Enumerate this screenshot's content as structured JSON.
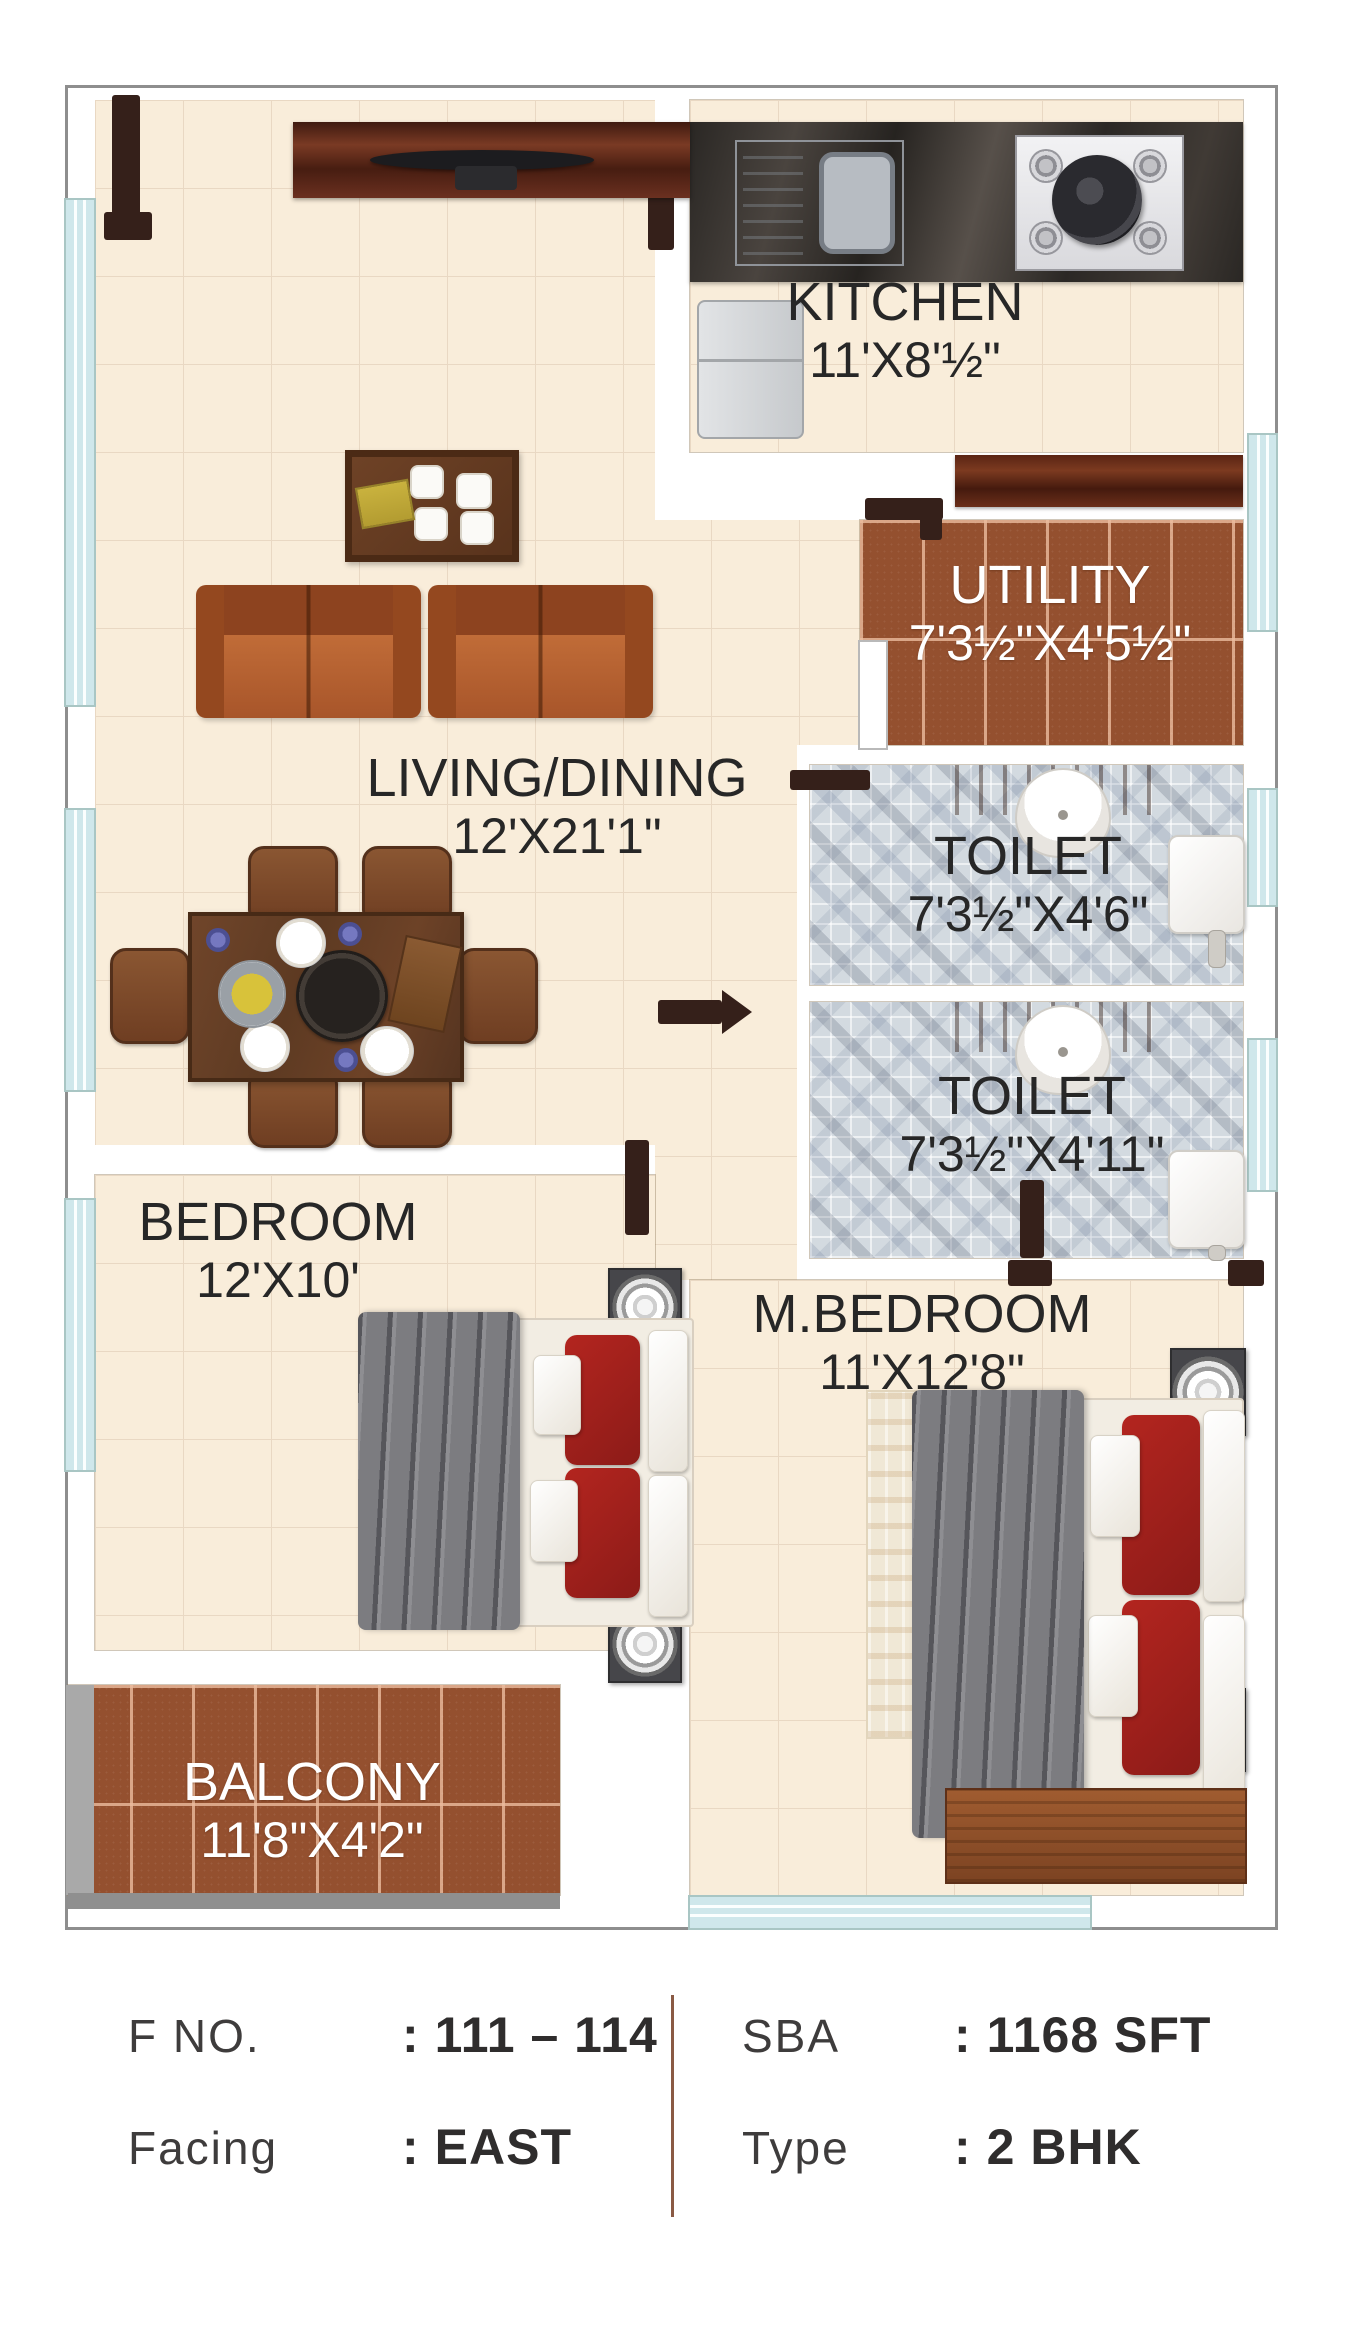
{
  "plan": {
    "rooms": [
      {
        "id": "kitchen",
        "name": "KITCHEN",
        "dims": "11'X8'½\""
      },
      {
        "id": "utility",
        "name": "UTILITY",
        "dims": "7'3½\"X4'5½\""
      },
      {
        "id": "toilet_top",
        "name": "TOILET",
        "dims": "7'3½\"X4'6\""
      },
      {
        "id": "toilet_bottom",
        "name": "TOILET",
        "dims": "7'3½\"X4'11\""
      },
      {
        "id": "living_dining",
        "name": "LIVING/DINING",
        "dims": "12'X21'1\""
      },
      {
        "id": "bedroom",
        "name": "BEDROOM",
        "dims": "12'X10'"
      },
      {
        "id": "master_bedroom",
        "name": "M.BEDROOM",
        "dims": "11'X12'8\""
      },
      {
        "id": "balcony",
        "name": "BALCONY",
        "dims": "11'8\"X4'2\""
      }
    ]
  },
  "info": {
    "left": [
      {
        "label": "F NO.",
        "sep": ":",
        "value": "111 – 114"
      },
      {
        "label": "Facing",
        "sep": ":",
        "value": "EAST"
      }
    ],
    "right": [
      {
        "label": "SBA",
        "sep": ":",
        "value": "1168 SFT"
      },
      {
        "label": "Type",
        "sep": ":",
        "value": "2 BHK"
      }
    ]
  },
  "colors": {
    "floor_cream": "#f9edda",
    "tile_terracotta": "#94502f",
    "mosaic_gray": "#d3dae0",
    "window_cyan": "#d2e9ed",
    "divider_brown": "#8a5a44"
  }
}
